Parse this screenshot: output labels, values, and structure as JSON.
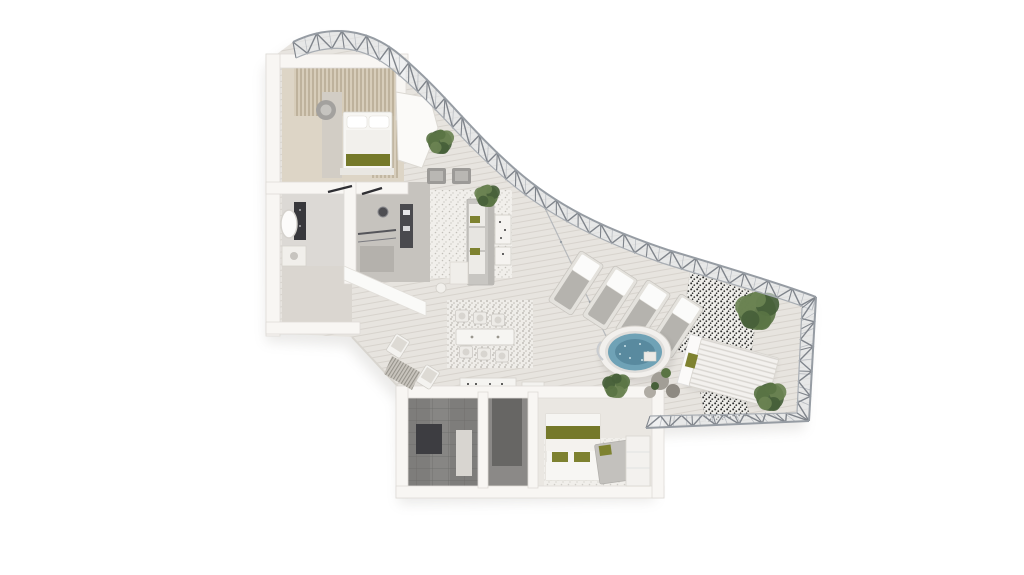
{
  "scene": {
    "type": "3d-floor-plan-render",
    "subject": "Aerial cutaway rendering of a luxury penthouse suite with curved glass facade, living and dining areas, two bedrooms, two bathrooms and a terrace with hot tub",
    "background": "#ffffff"
  },
  "palette": {
    "floor_base": "#e7e4df",
    "plank_line": "#d3cfc8",
    "glass": "#e8ebee",
    "steel": "#7f848b",
    "mullion": "#b5b9bf",
    "boundary": "#969ca3",
    "wall": "#f8f6f3",
    "wall_edge": "#d9d6d0",
    "olive_accent": "#75792a",
    "olive_bright": "#7e8230",
    "plant1": "#5a7444",
    "plant2": "#47603a",
    "plant3": "#6b8352",
    "water": "#6fa2b6",
    "water_deep": "#54859a",
    "water_rim": "#f2f0ed",
    "stone_floor": "#7e7d7b",
    "stone_mat": "#3d3d41",
    "marble": "#dcd9d5",
    "wood_floor": "#ddd5c6",
    "slat_bg": "#d7cdba",
    "slat_line": "#b3a78f",
    "sofa_gray": "#c8c6c2",
    "armchair_gray": "#9c9a97",
    "lounger_base": "#e4e2dd",
    "lounger_cushion": "#b5b3ae",
    "tile_bg": "#efeeea",
    "tile_dot": "#2e2e2e",
    "corridor_dark": "#676664",
    "bed2_floor": "#eae7e2",
    "rug_light": "#f1efeb",
    "cabana_stripe": "#d8d5d0"
  },
  "facade": {
    "style": "curved glass wall with triangulated steel truss",
    "zigzag_top": 24,
    "mullions_top": 48,
    "zigzag_right": 5,
    "mullions_right": 8,
    "zigzag_bottom": 7,
    "mullions_bottom": 12
  },
  "terrace": {
    "lounger_count": 4,
    "lounger_rotation": 33,
    "loungers": [
      {
        "x": 576,
        "y": 283
      },
      {
        "x": 610,
        "y": 298
      },
      {
        "x": 643,
        "y": 312
      },
      {
        "x": 676,
        "y": 326
      }
    ],
    "hot_tub": {
      "x": 635,
      "y": 352,
      "rx": 36,
      "ry": 26
    },
    "cabana": {
      "x": 734,
      "y": 372,
      "rotation": 15
    }
  },
  "plants": [
    {
      "x": 757,
      "y": 311,
      "r": 19
    },
    {
      "x": 770,
      "y": 397,
      "r": 14
    },
    {
      "x": 616,
      "y": 386,
      "r": 12
    },
    {
      "x": 487,
      "y": 196,
      "r": 11
    },
    {
      "x": 440,
      "y": 142,
      "r": 12
    }
  ],
  "dining": {
    "chair_count": 6,
    "chairs": [
      [
        462,
        316
      ],
      [
        480,
        318
      ],
      [
        498,
        320
      ],
      [
        466,
        352
      ],
      [
        484,
        354
      ],
      [
        502,
        356
      ]
    ]
  },
  "rooms": [
    {
      "id": "master-bedroom",
      "features": [
        "double-bed",
        "olive-throw",
        "wood-slat-wall",
        "armchair",
        "wardrobe"
      ]
    },
    {
      "id": "master-bathroom",
      "features": [
        "bathtub",
        "vanity",
        "dark-feature-wall",
        "basin"
      ]
    },
    {
      "id": "living-room",
      "features": [
        "sofa",
        "armchairs",
        "coffee-tables",
        "rug",
        "hanging-plant"
      ]
    },
    {
      "id": "dining-area",
      "features": [
        "table",
        "six-chairs",
        "rug",
        "sideboard"
      ]
    },
    {
      "id": "terrace",
      "features": [
        "sun-loungers",
        "hot-tub",
        "cabana-daybed",
        "patterned-tile",
        "potted-plants",
        "outdoor-chairs",
        "mat"
      ]
    },
    {
      "id": "second-bedroom",
      "features": [
        "bed-olive-accents",
        "chaise",
        "wardrobe",
        "rug"
      ]
    },
    {
      "id": "second-bathroom",
      "features": [
        "stone-floor",
        "dark-mat",
        "bench"
      ]
    },
    {
      "id": "corridor",
      "features": [
        "dark-passage"
      ]
    }
  ]
}
